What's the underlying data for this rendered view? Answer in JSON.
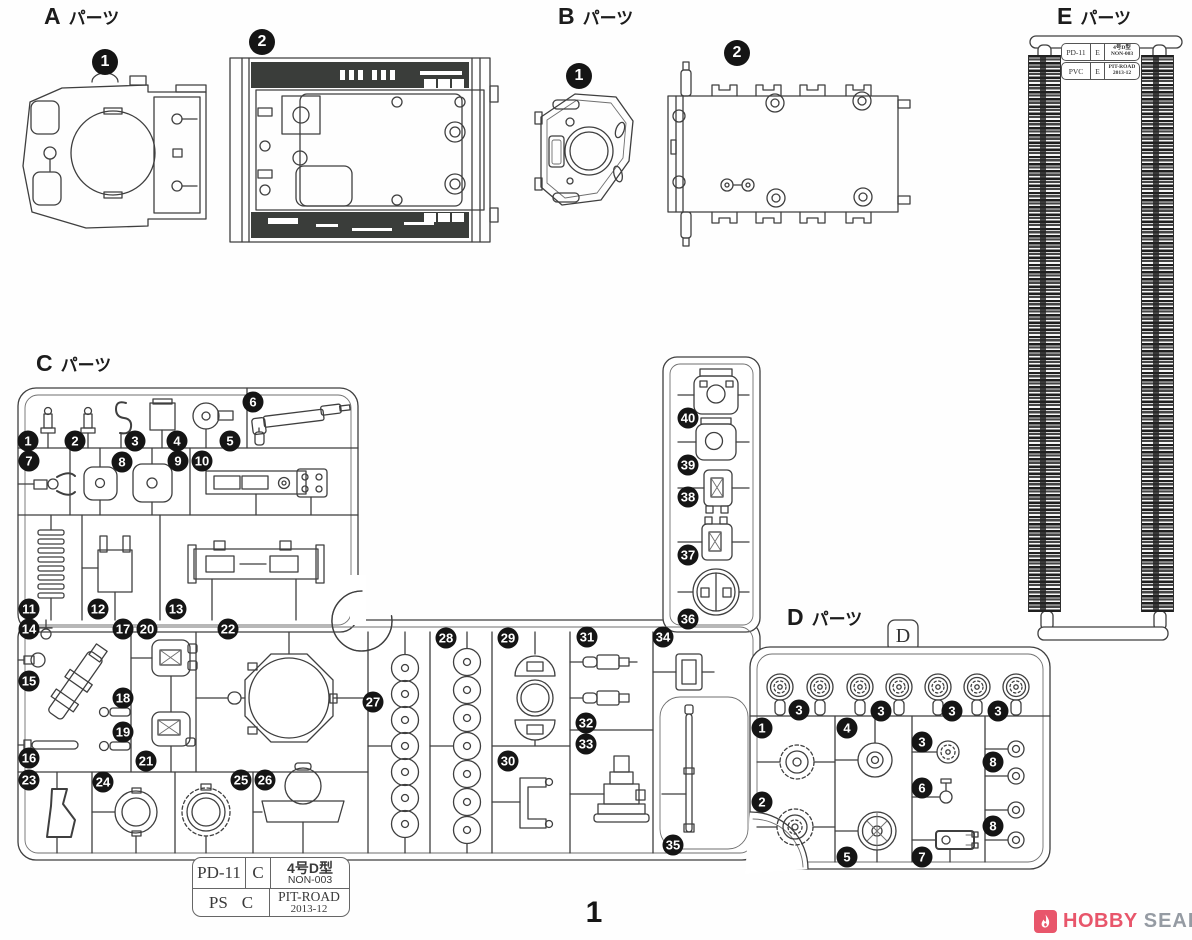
{
  "page": {
    "number": "1"
  },
  "titles": {
    "a": {
      "letter": "A",
      "word": "パーツ"
    },
    "b": {
      "letter": "B",
      "word": "パーツ"
    },
    "c": {
      "letter": "C",
      "word": "パーツ"
    },
    "d": {
      "letter": "D",
      "word": "パーツ"
    },
    "e": {
      "letter": "E",
      "word": "パーツ"
    }
  },
  "a_sprue": {
    "badges": [
      {
        "n": "1",
        "x": 105,
        "y": 62
      },
      {
        "n": "2",
        "x": 262,
        "y": 42
      }
    ]
  },
  "b_sprue": {
    "badges": [
      {
        "n": "1",
        "x": 579,
        "y": 76
      },
      {
        "n": "2",
        "x": 737,
        "y": 53
      }
    ]
  },
  "c_sprue": {
    "badges": [
      {
        "n": "1",
        "x": 28,
        "y": 441
      },
      {
        "n": "2",
        "x": 75,
        "y": 441
      },
      {
        "n": "3",
        "x": 135,
        "y": 441
      },
      {
        "n": "4",
        "x": 177,
        "y": 441
      },
      {
        "n": "5",
        "x": 230,
        "y": 441
      },
      {
        "n": "6",
        "x": 253,
        "y": 402
      },
      {
        "n": "7",
        "x": 29,
        "y": 461
      },
      {
        "n": "8",
        "x": 122,
        "y": 462
      },
      {
        "n": "9",
        "x": 178,
        "y": 461
      },
      {
        "n": "10",
        "x": 202,
        "y": 461
      },
      {
        "n": "11",
        "x": 29,
        "y": 609
      },
      {
        "n": "12",
        "x": 98,
        "y": 609
      },
      {
        "n": "13",
        "x": 176,
        "y": 609
      },
      {
        "n": "14",
        "x": 29,
        "y": 629
      },
      {
        "n": "15",
        "x": 29,
        "y": 681
      },
      {
        "n": "16",
        "x": 29,
        "y": 758
      },
      {
        "n": "17",
        "x": 123,
        "y": 629
      },
      {
        "n": "18",
        "x": 123,
        "y": 698
      },
      {
        "n": "19",
        "x": 123,
        "y": 732
      },
      {
        "n": "20",
        "x": 147,
        "y": 629
      },
      {
        "n": "21",
        "x": 146,
        "y": 761
      },
      {
        "n": "22",
        "x": 228,
        "y": 629
      },
      {
        "n": "23",
        "x": 29,
        "y": 780
      },
      {
        "n": "24",
        "x": 103,
        "y": 782
      },
      {
        "n": "25",
        "x": 241,
        "y": 780
      },
      {
        "n": "26",
        "x": 265,
        "y": 780
      },
      {
        "n": "27",
        "x": 373,
        "y": 702
      },
      {
        "n": "28",
        "x": 446,
        "y": 638
      },
      {
        "n": "29",
        "x": 508,
        "y": 638
      },
      {
        "n": "30",
        "x": 508,
        "y": 761
      },
      {
        "n": "31",
        "x": 587,
        "y": 637
      },
      {
        "n": "32",
        "x": 586,
        "y": 723
      },
      {
        "n": "33",
        "x": 586,
        "y": 744
      },
      {
        "n": "34",
        "x": 663,
        "y": 637
      },
      {
        "n": "35",
        "x": 673,
        "y": 845
      },
      {
        "n": "36",
        "x": 688,
        "y": 619
      },
      {
        "n": "37",
        "x": 688,
        "y": 555
      },
      {
        "n": "38",
        "x": 688,
        "y": 497
      },
      {
        "n": "39",
        "x": 688,
        "y": 465
      },
      {
        "n": "40",
        "x": 688,
        "y": 418
      }
    ]
  },
  "d_sprue": {
    "tab": "D",
    "badges": [
      {
        "n": "3",
        "x": 799,
        "y": 710
      },
      {
        "n": "3",
        "x": 881,
        "y": 711
      },
      {
        "n": "3",
        "x": 952,
        "y": 711
      },
      {
        "n": "3",
        "x": 998,
        "y": 711
      },
      {
        "n": "1",
        "x": 762,
        "y": 728
      },
      {
        "n": "4",
        "x": 847,
        "y": 728
      },
      {
        "n": "3",
        "x": 922,
        "y": 742
      },
      {
        "n": "8",
        "x": 993,
        "y": 762
      },
      {
        "n": "2",
        "x": 762,
        "y": 802
      },
      {
        "n": "6",
        "x": 922,
        "y": 788
      },
      {
        "n": "8",
        "x": 993,
        "y": 826
      },
      {
        "n": "5",
        "x": 847,
        "y": 857
      },
      {
        "n": "7",
        "x": 922,
        "y": 857
      }
    ]
  },
  "e_tag": {
    "r1": {
      "c1": "PD-11",
      "c2": "E",
      "c3a": "4号D型",
      "c3b": "NON-003"
    },
    "r2": {
      "c1": "PVC",
      "c2": "E",
      "c3a": "PIT-ROAD",
      "c3b": "2013-12"
    }
  },
  "c_tag": {
    "r1": {
      "c1": "PD-11",
      "c2": "C",
      "c3a": "4号D型",
      "c3b": "NON-003"
    },
    "r2": {
      "c1": "PS",
      "c2": "C",
      "c3a": "PIT-ROAD",
      "c3b": "2013-12"
    }
  },
  "watermark": {
    "word1": "HOBBY",
    "word2": "SEARCH",
    "accent": "#e8566b",
    "gray": "#959ba3"
  }
}
